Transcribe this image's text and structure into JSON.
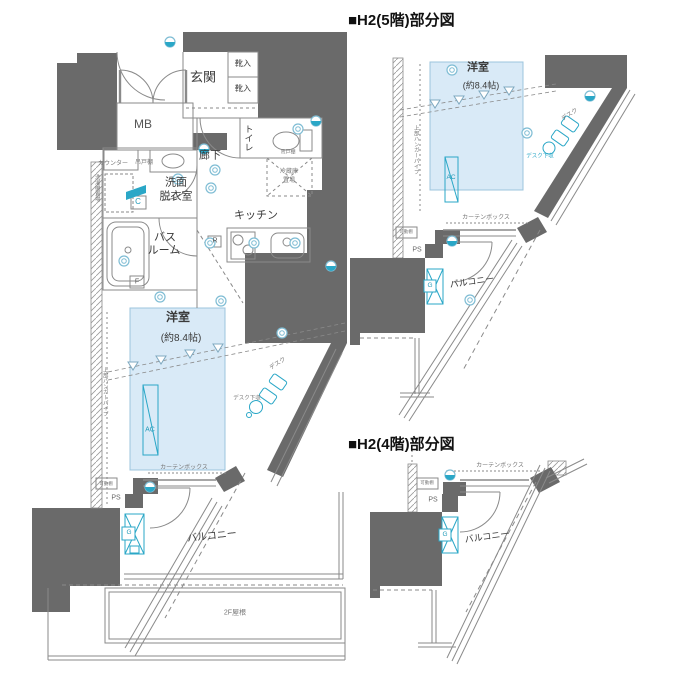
{
  "colors": {
    "wall": "#6a6a6a",
    "room_fill": "#d9eaf7",
    "accent": "#2aa7c7",
    "line": "#8a8a8a"
  },
  "main_plan": {
    "labels": {
      "genkan": "玄関",
      "shoe_upper": "靴入",
      "shoe_lower": "靴入",
      "mb": "MB",
      "toilet": "トイレ",
      "toilet_shelf": "吊戸棚",
      "hallway": "廊下",
      "counter": "カウンター",
      "hanging_shelf": "吊戸棚",
      "washer_place": "洗濯機置場",
      "washroom_1": "洗面",
      "washroom_2": "脱衣室",
      "label_c": "C",
      "bath_1": "バス",
      "bath_2": "ルーム",
      "label_f": "F",
      "kitchen": "キッチン",
      "label_r": "R",
      "fridge_1": "冷蔵庫",
      "fridge_2": "置場",
      "room": "洋室",
      "room_size": "(約8.4帖)",
      "ac": "AC",
      "desk": "デスク",
      "desk_storage": "デスク下収",
      "hanger_pipe": "上部ハンガーパイプ",
      "curtain_box": "カーテンボックス",
      "movable_shelf": "可動棚",
      "ps": "PS",
      "label_g": "G",
      "balcony": "バルコニー",
      "roof": "2F屋根"
    }
  },
  "partial_5f": {
    "header": "■H2(5階)部分図",
    "labels": {
      "room": "洋室",
      "room_size": "(約8.4帖)",
      "desk": "デスク",
      "desk_storage": "デスク下収",
      "ac": "AC",
      "hanger_pipe": "上部ハンガーパイプ",
      "curtain_box": "カーテンボックス",
      "movable_shelf": "可動棚",
      "ps": "PS",
      "label_g": "G",
      "balcony": "バルコニー"
    }
  },
  "partial_4f": {
    "header": "■H2(4階)部分図",
    "labels": {
      "curtain_box": "カーテンボックス",
      "movable_shelf": "可動棚",
      "ps": "PS",
      "label_g": "G",
      "balcony": "バルコニー"
    }
  }
}
